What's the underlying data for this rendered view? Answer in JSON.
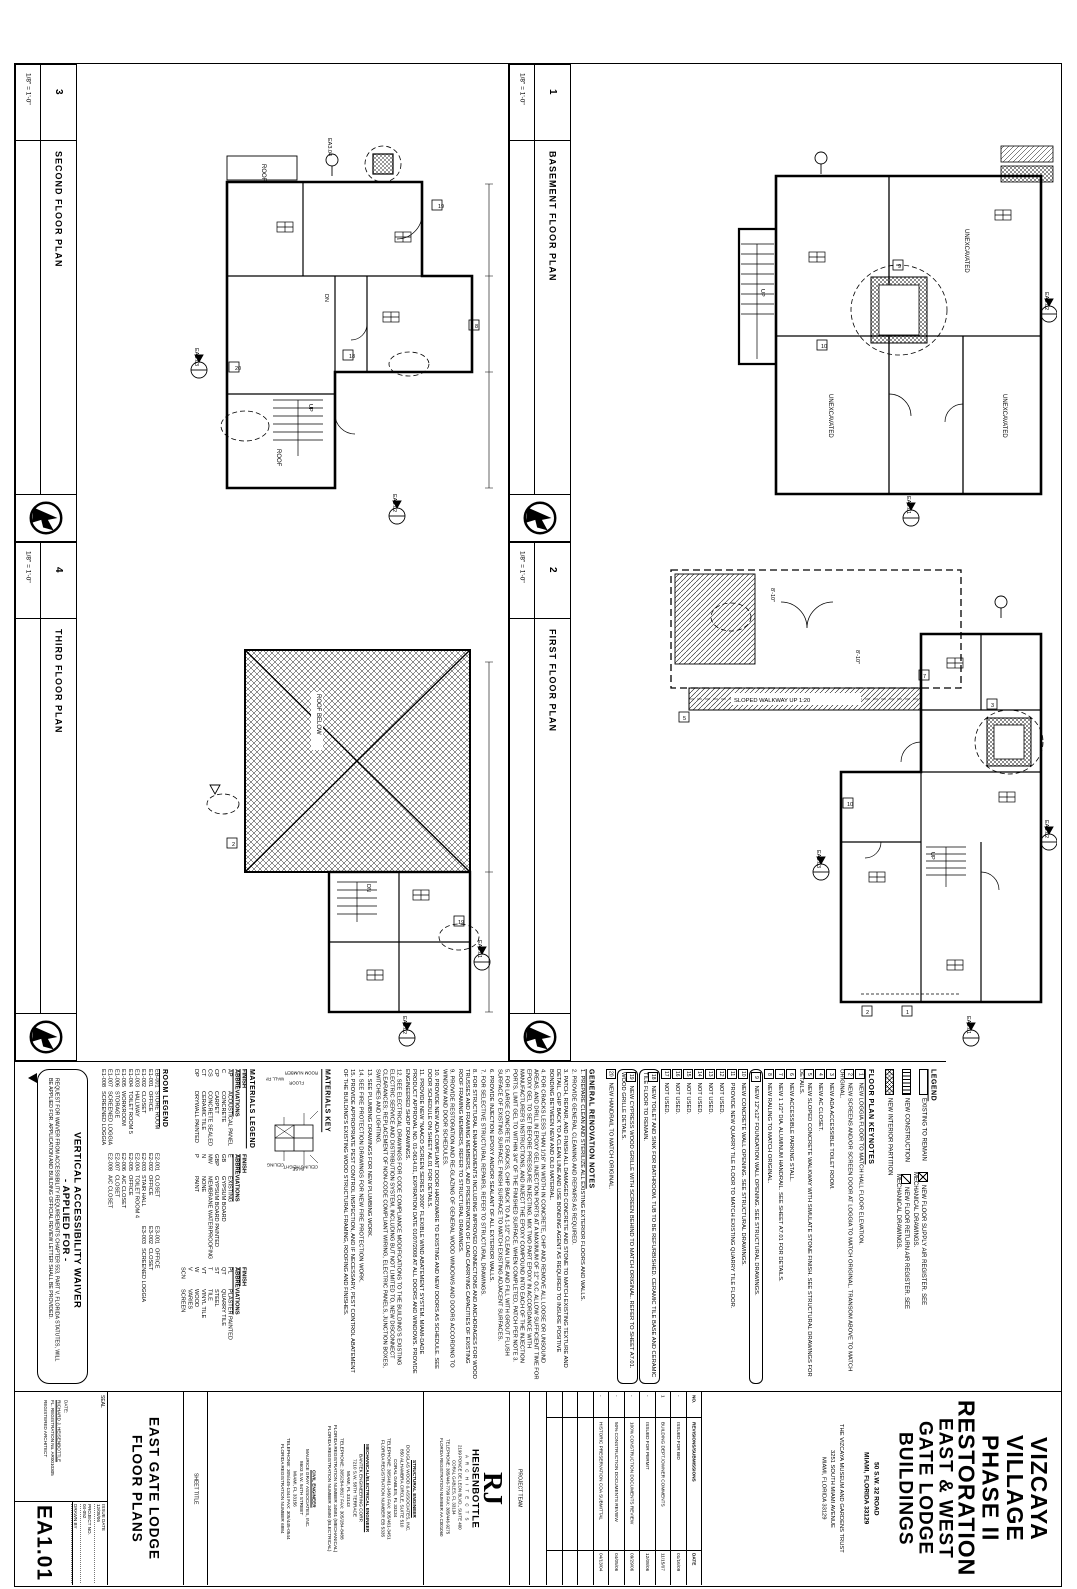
{
  "plans": [
    {
      "number": "3",
      "scale": "1/8\" = 1'-0\"",
      "title": "SECOND FLOOR PLAN"
    },
    {
      "number": "1",
      "scale": "1/8\" = 1'-0\"",
      "title": "BASEMENT FLOOR PLAN"
    },
    {
      "number": "4",
      "scale": "1/8\" = 1'-0\"",
      "title": "THIRD FLOOR PLAN"
    },
    {
      "number": "2",
      "scale": "1/8\" = 1'-0\"",
      "title": "FIRST FLOOR PLAN"
    }
  ],
  "plans_anno": {
    "second": {
      "roof": "ROOF",
      "roof2": "ROOF",
      "up": "UP",
      "dn": "DN",
      "markers": [
        "EA3.03",
        "EA3.02",
        "EA3.04"
      ],
      "keys": [
        "19",
        "8",
        "18",
        "20"
      ]
    },
    "basement": {
      "unexcavated": "UNEXCAVATED",
      "up": "UP",
      "markers": [
        "EA3.02",
        "EA3.01"
      ],
      "keys": [
        "9",
        "10"
      ]
    },
    "third": {
      "roof_below": "ROOF BELOW",
      "dn": "DN",
      "markers": [
        "EA3.02",
        "EA3.01"
      ],
      "keys": [
        "2",
        "19"
      ]
    },
    "first": {
      "walkway": "SLOPED WALKWAY UP 1:20",
      "dim": "8'-10\"",
      "up": "UP",
      "markers": [
        "EA3.03",
        "EA3.02",
        "EA3.01"
      ],
      "keys": [
        "5",
        "7",
        "3",
        "10",
        "2",
        "1"
      ]
    }
  },
  "legend": {
    "title": "LEGEND",
    "items": [
      {
        "label": "EXISTING TO REMAIN"
      },
      {
        "label": "NEW CONSTRUCTION"
      },
      {
        "label": "NEW INTERIOR PARTITION"
      },
      {
        "label": "NEW FLOOR SUPPLY AIR REGISTER. SEE MECHANICAL DRAWINGS."
      },
      {
        "label": "NEW FLOOR RETURN AIR REGISTER. SEE MECHANICAL DRAWINGS."
      }
    ]
  },
  "keynotes": {
    "title": "FLOOR PLAN KEYNOTES",
    "items": [
      {
        "no": "1",
        "text": "NEW LOGGIA FLOOR TO MATCH HALL FLOOR ELEVATION."
      },
      {
        "no": "2",
        "text": "NEW SCREENS AND/OR SCREEN DOOR AT LOGGIA TO MATCH ORIGINAL. TRANSOM ABOVE TO MATCH ORIGINAL."
      },
      {
        "no": "3",
        "text": "NEW ADA ACCESSIBLE TOILET ROOM."
      },
      {
        "no": "4",
        "text": "NEW AC CLOSET."
      },
      {
        "no": "5",
        "text": "NEW SLOPED CONCRETE WALKWAY WITH SIMULATE STONE FINISH. SEE STRUCTURAL DRAWINGS FOR DETAILS."
      },
      {
        "no": "6",
        "text": "NEW ACCESSIBLE PARKING STALL."
      },
      {
        "no": "7",
        "text": "NEW 1 1/2\" DIA. ALUMINUM HANDRAIL. SEE SHEET A7.01 FOR DETAILS."
      },
      {
        "no": "8",
        "text": "NEW RAILING TO MATCH ORIGINAL."
      },
      {
        "no": "9",
        "text": "NEW 12\"x12\" FOUNDATION WALL OPENING. SEE STRUCTURAL DRAWINGS.",
        "cloud": true
      },
      {
        "no": "10",
        "text": "NEW CONCRETE WALL OPENING. SEE STRUCTURAL DRAWINGS."
      },
      {
        "no": "11",
        "text": "PROVIDE NEW QUARRY TILE FLOOR TO MATCH EXISTING QUARRY TILE FLOOR."
      },
      {
        "no": "12",
        "text": "NOT USED."
      },
      {
        "no": "13",
        "text": "NOT USED."
      },
      {
        "no": "14",
        "text": "NOT USED."
      },
      {
        "no": "15",
        "text": "NOT USED."
      },
      {
        "no": "16",
        "text": "NOT USED."
      },
      {
        "no": "17",
        "text": "NOT USED."
      },
      {
        "no": "18",
        "text": "NEW TOILET AND SINK FOR BATHROOM. TUB TO BE REFURBISHED. CERAMIC TILE BASE AND CERAMIC TILE FLOOR TO REMAIN.",
        "cloud": true
      },
      {
        "no": "19",
        "text": "NEW CYPRESS WOOD GRILLE WITH SCREEN BEHIND TO MATCH ORIGINAL. REFER TO SHEET A7.01. WOOD GRILLE DETAILS.",
        "cloud": true
      },
      {
        "no": "20",
        "text": "NEW HANDRAIL TO MATCH ORIGINAL."
      }
    ]
  },
  "general_notes": {
    "title": "GENERAL RENOVATION NOTES",
    "items": [
      "1. PREPARE CLEAN AND STERILIZE ALL EXISTING EXTERIOR FLOORS AND WALLS.",
      "2. PROVIDE GENERAL CLEANING AND REPAIRS AS REQUIRED.",
      "3. PATCH, REPAIR, AND FINISH ALL DAMAGED CONCRETE AND STONE TO MATCH EXISTING TEXTURE AND DETAIL. CHIP BACK TO A CLEAN LINE AND USE BONDING AGENT AS REQUIRED TO INSURE POSITIVE BONDING BETWEEN NEW AND OLD MATERIAL.",
      "4. FOR CRACKS LESS THAN 1/16\" IN WIDTH IN CONCRETE, CHIP AND REMOVE ALL LOOSE OR UNSOUND AREAS, AND DRILL IN EPOXY GEL INJECTION PORTS AT A MAXIMUM OF 12\" O.C. ALLOW SUFFICIENT TIME FOR EPOXY GEL TO SET BEFORE PRESSURE INJECTING. MIX TWO PART EPOXY IN ACCORDANCE WITH MANUFACTURER'S INSTRUCTIONS, AND INJECT THE EPOXY COMPOUND INTO EACH OF THE INJECTION PORTS. LIMIT GEL TO WITHIN 3/4\" OF THE FINISHED SURFACE. WHEN COMPLETED, PATCH PER NOTE 3.",
      "5. FOR LARGE CONCRETE CRACKS, CHIP BACK TO A 1-1/2\" CLEAN LINE AND FILL WITH GROUT FLUSH SURFACE OF EXISTING SURFACE. FINISH SURFACE TO MATCH EXISTING ADJACENT SURFACES.",
      "6. PROVIDE INJECTION EPOXY AND/OR SEALANT OF ALL EXTERIOR WALLS.",
      "7. FOR SELECTIVE STRUCTURAL REPAIRS, REFER TO STRUCTURAL DRAWINGS.",
      "8. FOR STRUCTURAL ENHANCEMENTS INCLUDING IMPROVED CONNECTIONS AND ANCHORAGES FOR WOOD TRUSSES AND FRAMING MEMBERS, AND PRESERVATION OF LOAD CARRYING CAPACITIES OF EXISTING ROOF FRAMING MEMBERS, REFER TO STRUCTURAL DRAWINGS.",
      "9. PROVIDE RESTORATION AND RE-GLAZING OF GENERAL WOOD WINDOWS AND DOORS ACCORDING TO WINDOW AND DOOR SCHEDULES.",
      "10. PROVIDE NEW ADA COMPLIANT DOOR HARDWARE TO EXISTING AND NEW DOORS AS SCHEDULE. SEE DOOR SCHEDULE ON SHEET A6.01 FOR DETAILS.",
      "11. PROVIDE NEW \"NAACO SCREEN SERIES 2000\" FLEXIBLE WIND ABATEMENT SYSTEM. MIAMI-DADE PRODUCT APPROVAL NO. 01-0614.01, EXPIRATION DATE 01/07/2008 AT ALL DOORS AND WINDOWS. PROVIDE ENGINEERED SHOP DRAWINGS.",
      "12. SEE ELECTRICAL DRAWINGS FOR CODE COMPLIANCE MODIFICATIONS TO THE BUILDING'S EXISTING ELECTRIC SERVICE AND DISTRIBUTION SYSTEM, INCLUDING BUT NOT LIMITED TO, NEW DISCONNECT CLEARANCES; REPLACEMENT OF NON-CODE COMPLIANT WIRING, ELECTRIC PANELS, JUNCTION BOXES, SWITCHES AND LIGHTING.",
      "13. SEE PLUMBING DRAWINGS FOR NEW PLUMBING WORK.",
      "14. SEE FIRE PROTECTION DRAWINGS FOR NEW FIRE PROTECTION WORK.",
      "15. PROVIDE APPROPRIATE PEST CONTROL INSPECTION, AND IF NECESSARY, PEST CONTROL ABATEMENT OF THE BUILDING'S EXISTING WOOD STRUCTURAL FRAMING, ROOFING AND FINISHES."
    ]
  },
  "materials_key": {
    "title": "MATERIALS KEY",
    "labels": [
      "ROOM NUMBER",
      "FLOOR",
      "WALL FINISH",
      "CEILING HEIGHT",
      "BASE",
      "CEILING"
    ]
  },
  "materials_legend": {
    "title": "MATERIALS LEGEND",
    "finish_label": "FINISH",
    "abbrev_label": "ABBREVIATIONS",
    "columns": [
      [
        {
          "c": "AP",
          "n": "ACOUSTICAL PANEL"
        },
        {
          "c": "C",
          "n": "CONCRETE"
        },
        {
          "c": "CP",
          "n": "CARPET"
        },
        {
          "c": "CS",
          "n": "CONCRETE SEALED"
        },
        {
          "c": "CT",
          "n": "CERAMIC TILE"
        },
        {
          "c": "DP",
          "n": "DRYWALL PAINTED"
        }
      ],
      [
        {
          "c": "E",
          "n": "EXISTING"
        },
        {
          "c": "GB",
          "n": "GYPSUM BOARD"
        },
        {
          "c": "GBP",
          "n": "GYPSUM BOARD PAINTED"
        },
        {
          "c": "MW",
          "n": "MEMBRANE WATERPROOFING"
        },
        {
          "c": "N",
          "n": "NONE"
        },
        {
          "c": "P",
          "n": "PAINT"
        }
      ],
      [
        {
          "c": "PL",
          "n": "PLASTER PAINTED"
        },
        {
          "c": "QT",
          "n": "QUARRY TILE"
        },
        {
          "c": "ST",
          "n": "STEEL"
        },
        {
          "c": "T",
          "n": "TILE"
        },
        {
          "c": "VT",
          "n": "VINYL TILE"
        },
        {
          "c": "W",
          "n": "WOOD"
        },
        {
          "c": "V",
          "n": "VARIES"
        },
        {
          "c": "SCN",
          "n": "SCREEN"
        }
      ]
    ]
  },
  "room_legend": {
    "title": "ROOM LEGEND",
    "groups": [
      [
        {
          "c": "EB-001",
          "n": "STORE ROOM"
        },
        {
          "c": "E1-001",
          "n": "OFFICE"
        },
        {
          "c": "E1-002",
          "n": "CLOSET"
        },
        {
          "c": "E1-003",
          "n": "HALLWAY"
        },
        {
          "c": "E1-004",
          "n": "TOILET ROOM 5"
        },
        {
          "c": "E1-005",
          "n": "WORKROOM"
        },
        {
          "c": "E1-006",
          "n": "STORAGE"
        },
        {
          "c": "E1-007",
          "n": "SCREENED LOGGIA"
        },
        {
          "c": "E1-008",
          "n": "SCREENED LOGGIA"
        }
      ],
      [
        {
          "c": "E2-001",
          "n": "CLOSET"
        },
        {
          "c": "E2-002",
          "n": "OFFICE"
        },
        {
          "c": "E2-003",
          "n": "STAIR HALL"
        },
        {
          "c": "E2-004",
          "n": "TOILET ROOM 4"
        },
        {
          "c": "E2-005",
          "n": "OFFICE"
        },
        {
          "c": "E2-006",
          "n": "A/C CLOSET"
        },
        {
          "c": "E2-007",
          "n": "CLOSET"
        },
        {
          "c": "E2-008",
          "n": "A/C CLOSET"
        }
      ],
      [
        {
          "c": "E3-001",
          "n": "OFFICE"
        },
        {
          "c": "E3-002",
          "n": "CLOSET"
        },
        {
          "c": "E3-003",
          "n": "SCREENED LOGGIA"
        }
      ]
    ]
  },
  "waiver": {
    "line1": "VERTICAL ACCESSIBILITY WAIVER",
    "line2": "- APPLIED FOR -",
    "body": "REQUEST FOR WAIVER FROM ACCESSIBILITY REQUIREMENTS CHAPTER 553, PART V, FLORIDA STATUTES, WILL BE APPLIED FOR. APPLICATION AND BUILDING OFFICIAL REVIEW LETTER SHALL BE PROVIDED.",
    "rev": "1"
  },
  "titleblock": {
    "seal_label": "SEAL",
    "seal_lines": [
      "DATE:",
      "RICHARD J. HEISENBOTTLE",
      "FL. REGISTRATION No. AR0010305",
      "REGISTERED ARCHITECT"
    ],
    "fields": [
      {
        "label": "ISSUE DATE",
        "value": "12/08/06"
      },
      {
        "label": "PROJECT NO.",
        "value": "04-052"
      },
      {
        "label": "DRAWN BY",
        "value": ""
      }
    ],
    "sheet_number": "EA1.01",
    "sheet_title_label": "SHEET TITLE",
    "sheet_title_lines": [
      "EAST GATE LODGE",
      "FLOOR PLANS"
    ],
    "consultants": [
      {
        "role": "STRUCTURAL ENGINEER",
        "lines": [
          "DOUGLAS WOOD & ASSOCIATES, INC.",
          "850 ALHAMBRA CIRCLE, SUITE 510",
          "CORAL GABLES, FL 33134",
          "TELEPHONE: 305/461-3450   FAX: 305/461-3451",
          "FLORIDA REGISTRATION NUMBER EB 5335"
        ]
      },
      {
        "role": "MECHANICAL/ELECTRICAL ENGINEER",
        "lines": [
          "BANTEK ENGINEERING CORP.",
          "7210 S.W. 58TH TERRACE",
          "MIAMI, FL 33143",
          "TELEPHONE: 305/284-8817   FAX: 305/284-8488",
          "FLORIDA REGISTRATION NUMBER 34581 (MECHANICAL)",
          "FLORIDA REGISTRATION NUMBER 34580 (ELECTRICAL)"
        ]
      },
      {
        "role": "CIVIL ENGINEER",
        "lines": [
          "MAURICE GRAY ASSOCIATES, INC.",
          "8603 S.W. 94TH STREET",
          "MIAMI, FL 33156",
          "TELEPHONE: 305/445-1344   FAX: 305/445-0544",
          "FLORIDA REGISTRATION NUMBER 6884"
        ]
      }
    ],
    "architect": {
      "logo_big": "RJ",
      "name": "HEISENBOTTLE",
      "sub": "A R C H I T E C T S",
      "lines": [
        "2199 PONCE DE LEON BLVD., SUITE 400",
        "CORAL GABLES, FL 33134",
        "TELEPHONE: 305/446-7799   FAX: 305/446-9275",
        "FLORIDA REGISTRATION NUMBER AA C001060"
      ]
    },
    "project_team_label": "PROJECT TEAM",
    "revisions": {
      "no_label": "NO.",
      "desc_label": "REVISIONS/SUBMISSIONS",
      "date_label": "DATE",
      "rows": [
        {
          "no": "-",
          "desc": "ISSUED FOR BID",
          "date": "01/16/09"
        },
        {
          "no": "1",
          "tri": true,
          "desc": "BUILDING DEPT./OWNER COMMENTS",
          "date": "11/15/07"
        },
        {
          "no": "-",
          "desc": "ISSUED FOR PERMIT",
          "date": "12/08/06"
        },
        {
          "no": "-",
          "desc": "100% CONSTRUCTION DOCUMENTS REVIEW",
          "date": "09/29/06"
        },
        {
          "no": "-",
          "desc": "50% CONSTRUCTION DOCUMENTS REVIEW",
          "date": "04/05/06"
        },
        {
          "no": "-",
          "desc": "HISTORIC PRESERVATION COA SUBMITTAL",
          "date": "04/13/04"
        }
      ]
    },
    "project": {
      "name_lines": [
        "VIZCAYA",
        "VILLAGE",
        "PHASE II",
        "RESTORATION"
      ],
      "name2_lines": [
        "EAST & WEST",
        "GATE LODGE",
        "BUILDINGS"
      ],
      "address_lines": [
        "50 S.W. 32 ROAD",
        "MIAMI, FLORIDA 33129"
      ],
      "owner_lines": [
        "THE VIZCAYA MUSEUM AND GARDENS TRUST",
        "3251 SOUTH MIAMI AVENUE",
        "MIAMI, FLORIDA 33129"
      ]
    }
  }
}
